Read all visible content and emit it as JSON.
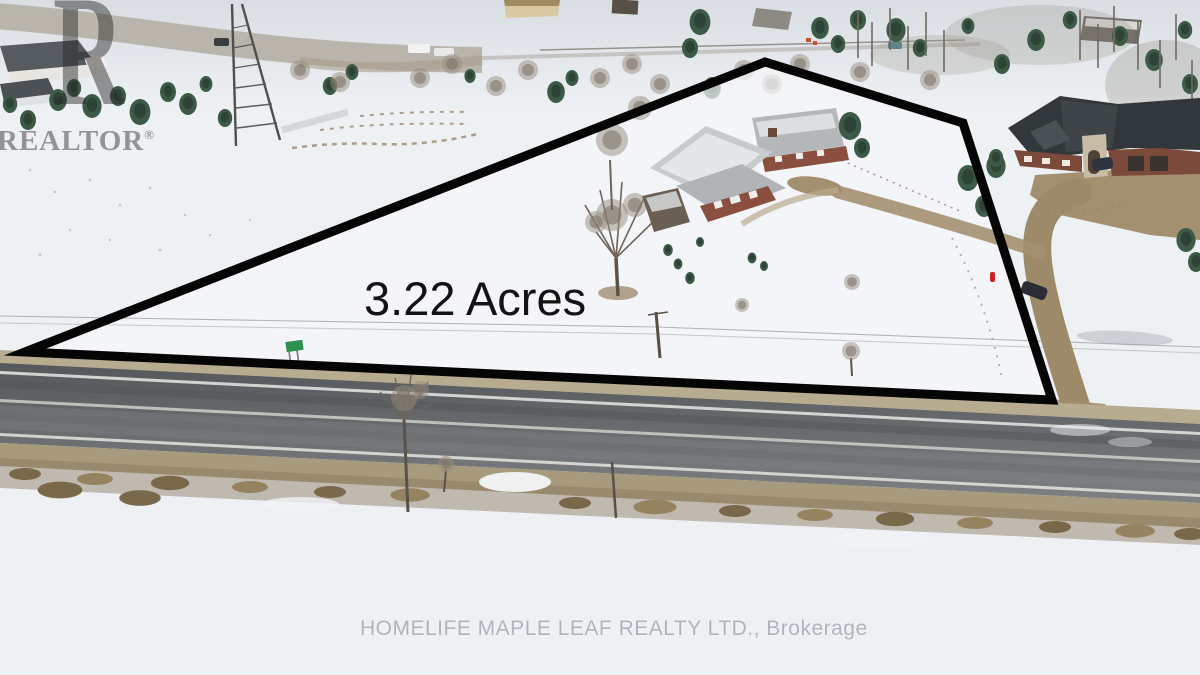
{
  "annotation": {
    "acreage_label": "3.22 Acres",
    "boundary_points": "25,352 765,62 963,123 1052,400",
    "boundary_color": "#050505"
  },
  "watermarks": {
    "realtor_letter": "R",
    "realtor_text": "REALTOR",
    "registered_symbol": "®",
    "brokerage_text": "HOMELIFE MAPLE LEAF REALTY LTD., Brokerage"
  },
  "scene": {
    "type": "aerial-winter-photo",
    "colors": {
      "snow": "#eef1f4",
      "asphalt": "#64686b",
      "gravel_shoulder": "#b3a78c",
      "driveway": "#a08c6a",
      "conifer": "#3c5a46",
      "house_brick": "#8a4f3f",
      "mansion_roof": "#31373a",
      "boundary": "#050505",
      "street_sign": "#2f8f4f"
    }
  }
}
